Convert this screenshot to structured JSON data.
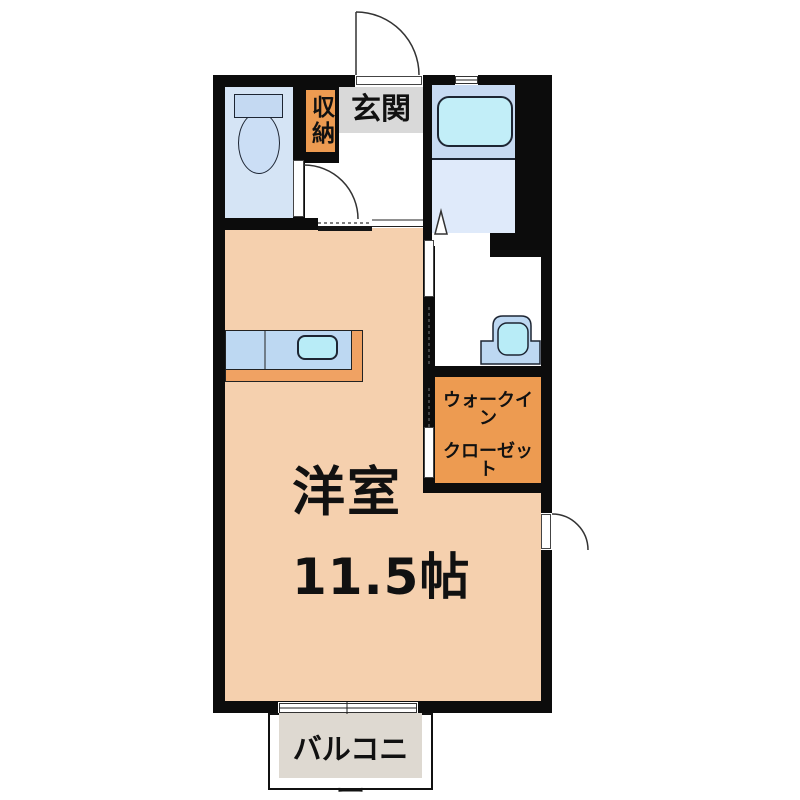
{
  "title": "1R apartment floor plan",
  "rooms": {
    "main_room": {
      "label_line1": "洋室",
      "label_line2": "11.5帖"
    },
    "entrance": {
      "label": "玄関"
    },
    "storage": {
      "label": "収納"
    },
    "walk_in_closet": {
      "label_line1": "ウォークイン",
      "label_line2": "クローゼット"
    },
    "balcony": {
      "label": "バルコニー"
    },
    "toilet": {
      "icon": "toilet-icon"
    },
    "bathroom": {
      "icon": "bathtub-icon"
    },
    "washroom": {
      "icon": "washbasin-icon"
    },
    "kitchen": {
      "icon": "kitchen-sink-icon"
    }
  },
  "colors": {
    "wall": "#0c0c0c",
    "main_room_floor": "#f5d0ae",
    "accent_orange": "#ed9b51",
    "counter_orange": "#f0a263",
    "entrance_gray": "#d9d9d9",
    "balcony_beige": "#ded9d1",
    "toilet_floor": "#d5e4f5",
    "fixture_blue": "#c4d9f2",
    "fixture_blue_light": "#cbdef5",
    "bath_platform": "#c7daf2",
    "bath_floor": "#dfeafa",
    "tub_cyan": "#c2eef8",
    "sink_cyan": "#b8ecf7",
    "sink_blue": "#bdd8f2"
  }
}
